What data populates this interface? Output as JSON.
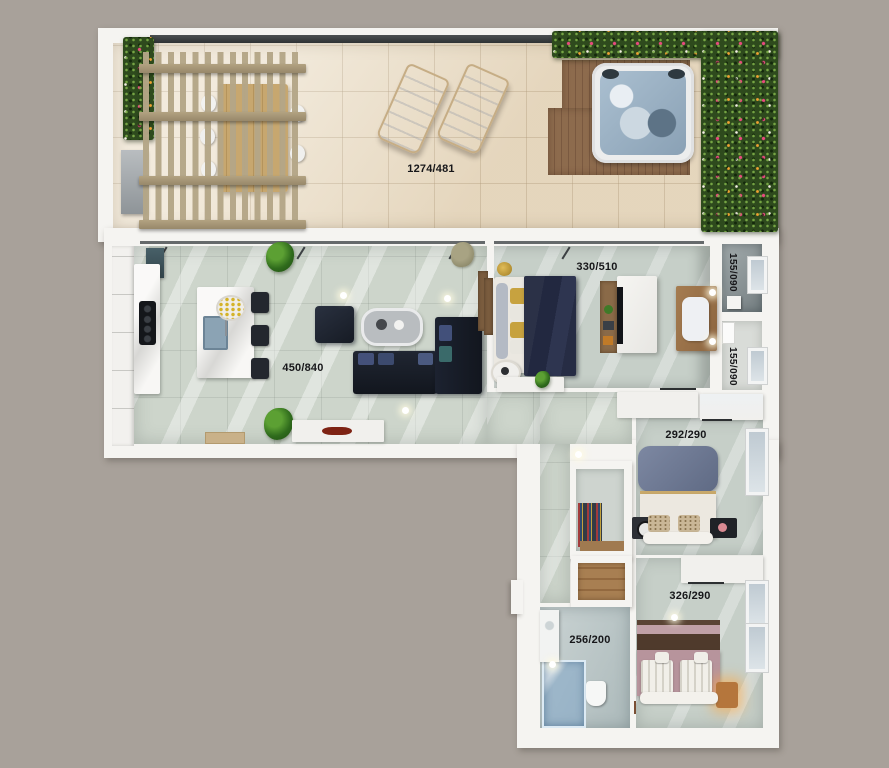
{
  "plan_type": "apartment-top-view-floor-plan",
  "background": "#a8a19a",
  "rooms": {
    "terrace": {
      "dimensions": "1274/481"
    },
    "living_kitchen": {
      "dimensions": "450/840"
    },
    "master_bedroom": {
      "dimensions": "330/510"
    },
    "utility_top": {
      "dimensions": "155/090"
    },
    "utility_bottom": {
      "dimensions": "155/090"
    },
    "bedroom_middle": {
      "dimensions": "292/290"
    },
    "bedroom_bottom": {
      "dimensions": "326/290"
    },
    "bathroom": {
      "dimensions": "256/200"
    }
  },
  "colors": {
    "wall": "#f5f4f1",
    "terrace_floor": "#ebdfc9",
    "indoor_floor": "#cdd5cb",
    "bathroom_floor": "#b9c5c5",
    "hedge_green": "#2e4a1d",
    "flower_pink": "#e84a7e",
    "flower_orange": "#f0a232",
    "deck_wood": "#8d6b4d",
    "pergola_wood": "#b2a281",
    "sofa_navy": "#161b24",
    "blanket_navy": "#2a3044",
    "pillow_gray_blue": "#6f7a92",
    "headboard_mauve": "#b7949c",
    "headboard_brown": "#4f3a2c",
    "hot_tub_water": "#9fb6ca",
    "label_text": "#17171a"
  }
}
